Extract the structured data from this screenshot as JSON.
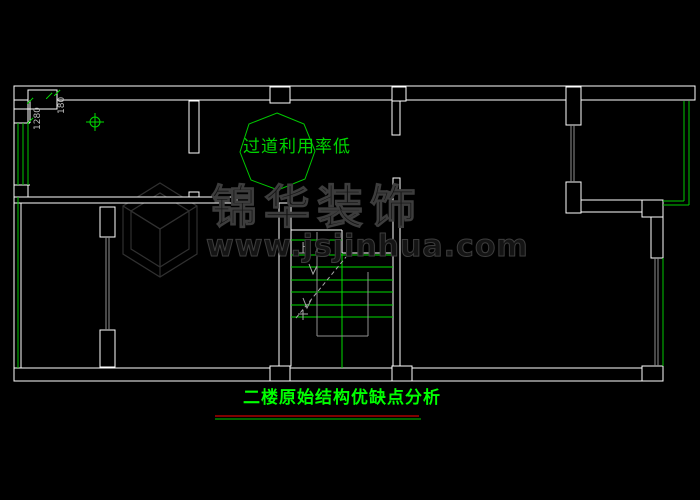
{
  "app": {
    "type": "cad-floorplan-view",
    "background": "#000000"
  },
  "colors": {
    "wall_white": "#ffffff",
    "drawing_green": "#00c800",
    "stair_green": "#00dc00",
    "title_green": "#00ff00",
    "underline_red": "#ff0000",
    "annotation_gray": "#9e9e9e",
    "dimension_gray": "#bdbdbd",
    "watermark_gray": "#3d3d3d"
  },
  "drawing": {
    "corridor_note": "过道利用率低",
    "stair_direction_label": "上",
    "dimensions": [
      {
        "label": "1280"
      },
      {
        "label": "180"
      }
    ]
  },
  "watermark": {
    "logo": "cube-wireframe",
    "brand": "锦华装饰",
    "website": "www.jsjinhua.com"
  },
  "footer": {
    "title": "二楼原始结构优缺点分析"
  }
}
